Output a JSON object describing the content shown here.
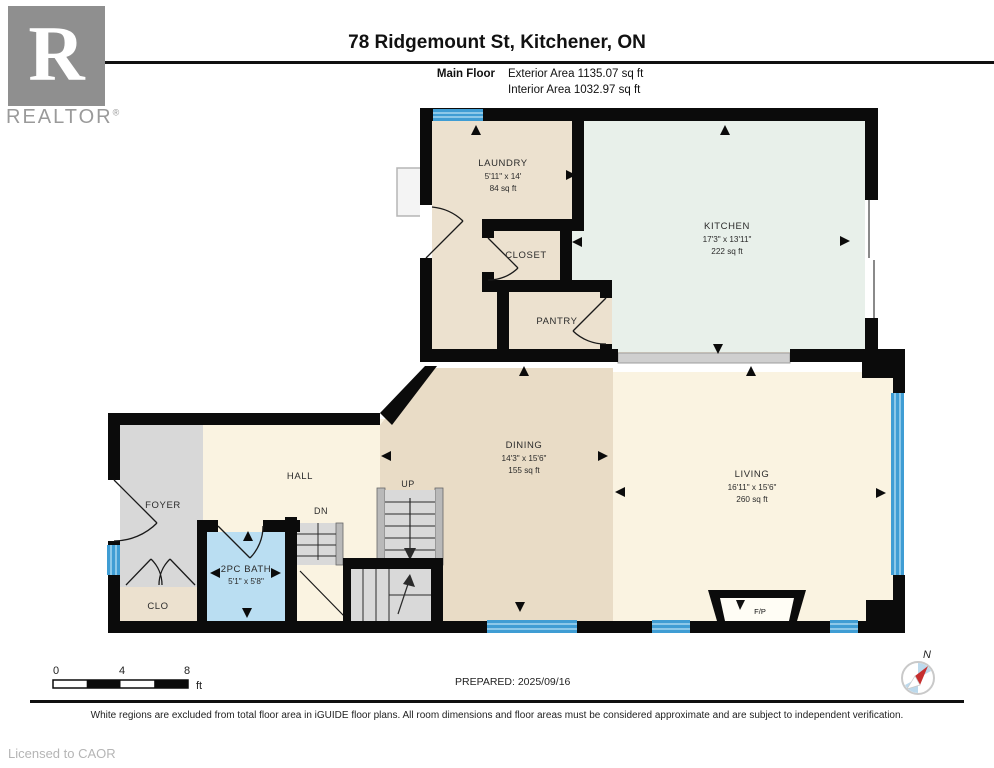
{
  "header": {
    "logo_letter": "R",
    "logo_word": "REALTOR",
    "logo_reg": "®",
    "title": "78 Ridgemount St, Kitchener, ON",
    "floor_label": "Main Floor",
    "exterior_area": "Exterior Area 1135.07 sq ft",
    "interior_area": "Interior Area 1032.97 sq ft"
  },
  "rooms": {
    "laundry": {
      "name": "LAUNDRY",
      "dims": "5'11\" x 14'",
      "area": "84 sq ft"
    },
    "closet": {
      "name": "CLOSET"
    },
    "pantry": {
      "name": "PANTRY"
    },
    "kitchen": {
      "name": "KITCHEN",
      "dims": "17'3\" x 13'11\"",
      "area": "222 sq ft"
    },
    "dining": {
      "name": "DINING",
      "dims": "14'3\" x 15'6\"",
      "area": "155 sq ft"
    },
    "living": {
      "name": "LIVING",
      "dims": "16'11\" x 15'6\"",
      "area": "260 sq ft"
    },
    "hall": {
      "name": "HALL"
    },
    "foyer": {
      "name": "FOYER"
    },
    "clo": {
      "name": "CLO"
    },
    "bath": {
      "name": "2PC BATH",
      "dims": "5'1\" x 5'8\""
    },
    "fireplace": {
      "name": "F/P"
    },
    "stairs_up": "UP",
    "stairs_dn": "DN"
  },
  "colors": {
    "wall": "#0b0b0b",
    "beige": "#ece1cf",
    "kitchen_green": "#e8f0ea",
    "dining_beige": "#e9dcc6",
    "cream": "#faf3e1",
    "foyer_grey": "#d8d8d8",
    "bath_blue": "#badef2",
    "stairs_grey": "#d9d9d9",
    "window_blue": "#3f9dd4"
  },
  "scale_bar": {
    "tick0": "0",
    "tick4": "4",
    "tick8": "8",
    "unit": "ft"
  },
  "compass": {
    "north": "N"
  },
  "prepared": "PREPARED: 2025/09/16",
  "disclaimer": "White regions are excluded from total floor area in iGUIDE floor plans. All room dimensions and floor areas must be considered approximate and are subject to independent verification.",
  "licensed": "Licensed to CAOR"
}
